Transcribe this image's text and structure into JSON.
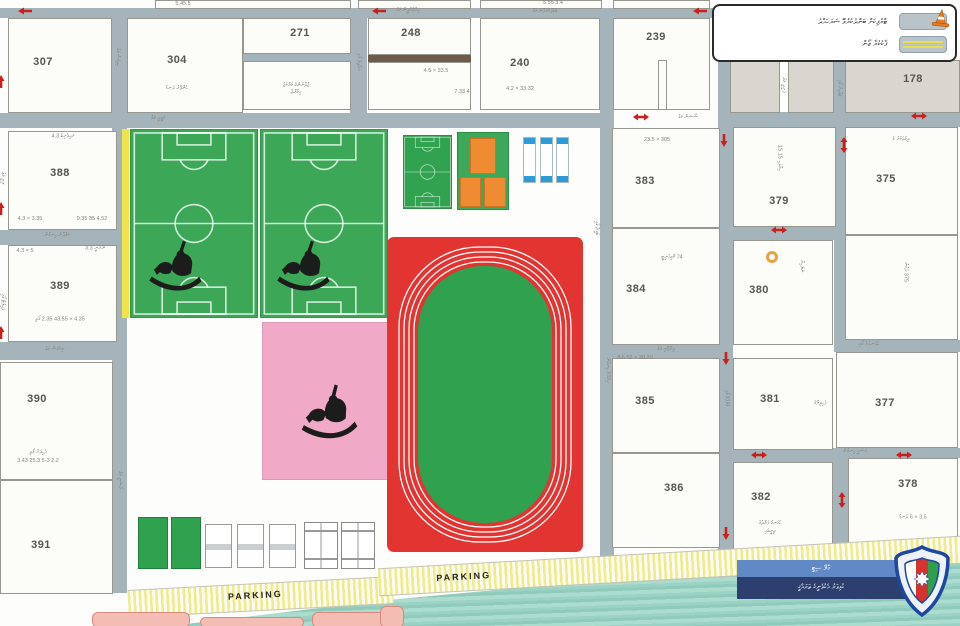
{
  "legend": {
    "items": [
      {
        "label": "ޓްރެފިކަށް ބަންދުކުރެވޭ ސަރަހައްދު",
        "symbol": "traffic-cone"
      },
      {
        "label": "ޕާކުކުރާ ޒޯން",
        "symbol": "yellow-parking-lines"
      }
    ]
  },
  "banner": {
    "line1": "މާލޭ ސިޓީ",
    "line2": "ކުޅިވަރު އެކުވެނީގެ ތަރައްޤީ"
  },
  "parking_labels": [
    "PARKING",
    "PARKING"
  ],
  "colors": {
    "street": "#a5b4bb",
    "block": "#fcfcf9",
    "gray_block": "#d9d6d0",
    "field_green": "#3ba757",
    "infield_green": "#2fa14f",
    "track_red": "#e23430",
    "pink_court": "#f0a9c7",
    "orange_court": "#ee8b33",
    "blue_cap": "#2f9bd6",
    "yellow_stripe": "#efe34a",
    "water": "#9ad2c3",
    "arrow_red": "#c9201d",
    "banner_blue": "#6089c5",
    "banner_navy": "#2c3f6f",
    "cone_orange": "#e87a26",
    "building_salmon": "#f3bdb4"
  },
  "map": {
    "blocks": [
      {
        "n": "307",
        "x": 8,
        "y": 18,
        "w": 104,
        "h": 95,
        "nx": 43,
        "ny": 62
      },
      {
        "n": "304",
        "x": 127,
        "y": 18,
        "w": 116,
        "h": 95,
        "nx": 177,
        "ny": 60
      },
      {
        "n": "271",
        "x": 243,
        "y": 18,
        "w": 108,
        "h": 36,
        "nx": 300,
        "ny": 33
      },
      {
        "n": "",
        "x": 243,
        "y": 61,
        "w": 108,
        "h": 49
      },
      {
        "n": "248",
        "x": 368,
        "y": 18,
        "w": 103,
        "h": 37,
        "nx": 411,
        "ny": 33
      },
      {
        "n": "",
        "x": 368,
        "y": 62,
        "w": 103,
        "h": 48
      },
      {
        "n": "240",
        "x": 480,
        "y": 18,
        "w": 120,
        "h": 92,
        "nx": 520,
        "ny": 63
      },
      {
        "n": "239",
        "x": 613,
        "y": 18,
        "w": 97,
        "h": 92,
        "nx": 656,
        "ny": 37
      },
      {
        "n": "",
        "x": 658,
        "y": 60,
        "w": 9,
        "h": 50
      },
      {
        "n": "",
        "x": 730,
        "y": 60,
        "w": 50,
        "h": 53,
        "gray": true
      },
      {
        "n": "",
        "x": 788,
        "y": 60,
        "w": 46,
        "h": 53,
        "gray": true
      },
      {
        "n": "178",
        "x": 845,
        "y": 60,
        "w": 115,
        "h": 53,
        "gray": true,
        "nx": 913,
        "ny": 79
      },
      {
        "n": "388",
        "x": 8,
        "y": 131,
        "w": 109,
        "h": 99,
        "nx": 60,
        "ny": 173
      },
      {
        "n": "389",
        "x": 8,
        "y": 245,
        "w": 109,
        "h": 97,
        "nx": 60,
        "ny": 286
      },
      {
        "n": "390",
        "x": 0,
        "y": 362,
        "w": 113,
        "h": 118,
        "nx": 37,
        "ny": 399
      },
      {
        "n": "391",
        "x": 0,
        "y": 480,
        "w": 113,
        "h": 114,
        "nx": 41,
        "ny": 545
      },
      {
        "n": "383",
        "x": 612,
        "y": 128,
        "w": 108,
        "h": 100,
        "nx": 645,
        "ny": 181
      },
      {
        "n": "384",
        "x": 612,
        "y": 228,
        "w": 108,
        "h": 117,
        "nx": 636,
        "ny": 289
      },
      {
        "n": "385",
        "x": 612,
        "y": 358,
        "w": 108,
        "h": 95,
        "nx": 645,
        "ny": 401
      },
      {
        "n": "386",
        "x": 612,
        "y": 453,
        "w": 108,
        "h": 95,
        "nx": 674,
        "ny": 488
      },
      {
        "n": "379",
        "x": 733,
        "y": 127,
        "w": 103,
        "h": 100,
        "nx": 779,
        "ny": 201
      },
      {
        "n": "375",
        "x": 845,
        "y": 127,
        "w": 113,
        "h": 108,
        "nx": 886,
        "ny": 179
      },
      {
        "n": "",
        "x": 845,
        "y": 235,
        "w": 113,
        "h": 105
      },
      {
        "n": "380",
        "x": 733,
        "y": 240,
        "w": 100,
        "h": 105,
        "nx": 759,
        "ny": 290
      },
      {
        "n": "381",
        "x": 733,
        "y": 358,
        "w": 100,
        "h": 92,
        "nx": 770,
        "ny": 399
      },
      {
        "n": "382",
        "x": 733,
        "y": 462,
        "w": 100,
        "h": 91,
        "nx": 761,
        "ny": 497
      },
      {
        "n": "377",
        "x": 836,
        "y": 352,
        "w": 122,
        "h": 96,
        "nx": 885,
        "ny": 403
      },
      {
        "n": "378",
        "x": 848,
        "y": 458,
        "w": 110,
        "h": 88,
        "nx": 908,
        "ny": 484
      },
      {
        "n": "",
        "x": 155,
        "y": 0,
        "w": 196,
        "h": 9
      },
      {
        "n": "",
        "x": 358,
        "y": 0,
        "w": 113,
        "h": 9
      },
      {
        "n": "",
        "x": 480,
        "y": 0,
        "w": 122,
        "h": 9
      },
      {
        "n": "",
        "x": 613,
        "y": 0,
        "w": 97,
        "h": 9
      }
    ],
    "streets": [
      [
        0,
        8,
        718,
        10
      ],
      [
        112,
        18,
        15,
        575
      ],
      [
        350,
        18,
        17,
        95
      ],
      [
        0,
        113,
        614,
        15
      ],
      [
        600,
        8,
        14,
        552
      ],
      [
        718,
        60,
        15,
        493
      ],
      [
        834,
        60,
        12,
        292
      ],
      [
        718,
        112,
        242,
        15
      ],
      [
        718,
        227,
        128,
        13
      ],
      [
        846,
        340,
        114,
        12
      ],
      [
        600,
        345,
        133,
        13
      ],
      [
        718,
        450,
        130,
        12
      ],
      [
        846,
        448,
        114,
        10
      ],
      [
        833,
        448,
        15,
        105
      ],
      [
        0,
        230,
        120,
        15
      ],
      [
        0,
        342,
        120,
        18
      ],
      [
        243,
        54,
        108,
        7
      ],
      [
        506,
        18,
        9,
        20
      ],
      [
        545,
        18,
        8,
        45
      ],
      [
        368,
        55,
        103,
        7,
        "#6e5b49"
      ]
    ],
    "labels": [
      {
        "t": "ބޮޑުތަކުރުފާނު މަގު",
        "x": 545,
        "y": 12
      },
      {
        "t": "އިއްޒުއްދީން މަގު",
        "x": 408,
        "y": 11
      },
      {
        "t": "މަޖީދީ މަގު",
        "x": 158,
        "y": 119
      },
      {
        "t": "ސޯސަން މަގު",
        "x": 688,
        "y": 118
      },
      {
        "t": "ކަލާފާނު ހިނގުން",
        "x": 57,
        "y": 236
      },
      {
        "t": "ނިކަގަސް މަގު",
        "x": 55,
        "y": 350
      },
      {
        "t": "ފިޔާތޮށި މަގު",
        "x": 666,
        "y": 350
      },
      {
        "t": "ހުވަނދުމާ ގޯޅި",
        "x": 869,
        "y": 345
      },
      {
        "t": "އަސަރީ ހިނގުން",
        "x": 855,
        "y": 452
      },
      {
        "t": "ގުލްފާމް ގޯޅި",
        "x": 726,
        "y": 398,
        "v": 1
      },
      {
        "t": "އިރުދޭމާ ހިނގުން",
        "x": 607,
        "y": 370,
        "v": 1
      },
      {
        "t": "ރޯޝަނީ މަގު",
        "x": 119,
        "y": 480,
        "v": 1
      },
      {
        "t": "ހިތިގަސް މަގު",
        "x": 117,
        "y": 57,
        "v": 1
      },
      {
        "t": "ރަތްވިލާ ގޯޅި",
        "x": 358,
        "y": 62,
        "v": 1
      },
      {
        "t": "ބަގީޗާ ގޯޅި",
        "x": 596,
        "y": 228,
        "v": 1
      },
      {
        "t": "ފަރީދީ މަގު",
        "x": 783,
        "y": 85,
        "v": 1
      },
      {
        "t": "ޖަވާހިރު ގޯޅި",
        "x": 839,
        "y": 88,
        "v": 1
      },
      {
        "t": "ލިލީ މަގު",
        "x": 2,
        "y": 178,
        "v": 1
      },
      {
        "t": "ވައިލެޓް ގޯޅި",
        "x": 2,
        "y": 302,
        "v": 1
      },
      {
        "t": "ހެންވޭރު ދަނޑު",
        "x": 177,
        "y": 89
      },
      {
        "t": "ޒުވާނުންގެ މަރުކަޒު",
        "x": 296,
        "y": 86
      },
      {
        "t": "އިމާރާތް",
        "x": 296,
        "y": 93
      },
      {
        "t": "33.5 × 4.5",
        "x": 436,
        "y": 71
      },
      {
        "t": "4 7.33",
        "x": 462,
        "y": 92
      },
      {
        "t": "33.32 × 4.2",
        "x": 520,
        "y": 89
      },
      {
        "t": "305 × 23.5",
        "x": 657,
        "y": 140
      },
      {
        "t": "74 ކޮމިއުނިޓީ",
        "x": 672,
        "y": 258
      },
      {
        "t": "20.20 × 8.6.52",
        "x": 635,
        "y": 358
      },
      {
        "t": "ހުޅަނގު ފަރާތުގެ",
        "x": 770,
        "y": 524
      },
      {
        "t": "ތިރީބައި",
        "x": 770,
        "y": 532
      },
      {
        "t": "3.5 × 6 ދަނޑު",
        "x": 913,
        "y": 518
      },
      {
        "t": "ފެހިވިލާގެ",
        "x": 820,
        "y": 404
      },
      {
        "t": "ދިގުތަކުރު ގެ",
        "x": 901,
        "y": 140
      },
      {
        "t": "ހިޔާވަހި 15.15",
        "x": 779,
        "y": 158,
        "v": 1
      },
      {
        "t": "ނަލަހިޔާ",
        "x": 801,
        "y": 266,
        "v": 1
      },
      {
        "t": "375 ދެކުނު",
        "x": 905,
        "y": 272,
        "v": 1
      },
      {
        "t": "ރައިވެރިބެ 4.3",
        "x": 63,
        "y": 137
      },
      {
        "t": "3.35 × 4.3",
        "x": 30,
        "y": 219
      },
      {
        "t": "4.52 35 9.35",
        "x": 92,
        "y": 219
      },
      {
        "t": "5 × 4.3",
        "x": 25,
        "y": 251
      },
      {
        "t": "ނޫރާނީ 3.3",
        "x": 95,
        "y": 249
      },
      {
        "t": "4.35 × 43.55 2.35 ގޯތި",
        "x": 60,
        "y": 320
      },
      {
        "t": "ފެހިފަރު ގޯތި",
        "x": 38,
        "y": 453
      },
      {
        "t": "2.2 5-3 25.3 3.43",
        "x": 38,
        "y": 461
      },
      {
        "t": "5.45.5",
        "x": 183,
        "y": 4
      },
      {
        "t": "3.4 5.55",
        "x": 553,
        "y": 3
      }
    ],
    "arrows": [
      {
        "x": 18,
        "y": 7,
        "t": "left"
      },
      {
        "x": 372,
        "y": 7,
        "t": "left"
      },
      {
        "x": 693,
        "y": 7,
        "t": "left"
      },
      {
        "x": 633,
        "y": 113,
        "t": "h2"
      },
      {
        "x": 911,
        "y": 112,
        "t": "h2"
      },
      {
        "x": 840,
        "y": 137,
        "t": "v2"
      },
      {
        "x": 720,
        "y": 134,
        "t": "down"
      },
      {
        "x": 771,
        "y": 226,
        "t": "h2"
      },
      {
        "x": -3,
        "y": 75,
        "t": "up"
      },
      {
        "x": -3,
        "y": 202,
        "t": "up"
      },
      {
        "x": -3,
        "y": 326,
        "t": "up"
      },
      {
        "x": 722,
        "y": 352,
        "t": "down"
      },
      {
        "x": 751,
        "y": 451,
        "t": "h2"
      },
      {
        "x": 896,
        "y": 451,
        "t": "h2"
      },
      {
        "x": 838,
        "y": 492,
        "t": "v2"
      },
      {
        "x": 722,
        "y": 527,
        "t": "down"
      }
    ]
  }
}
